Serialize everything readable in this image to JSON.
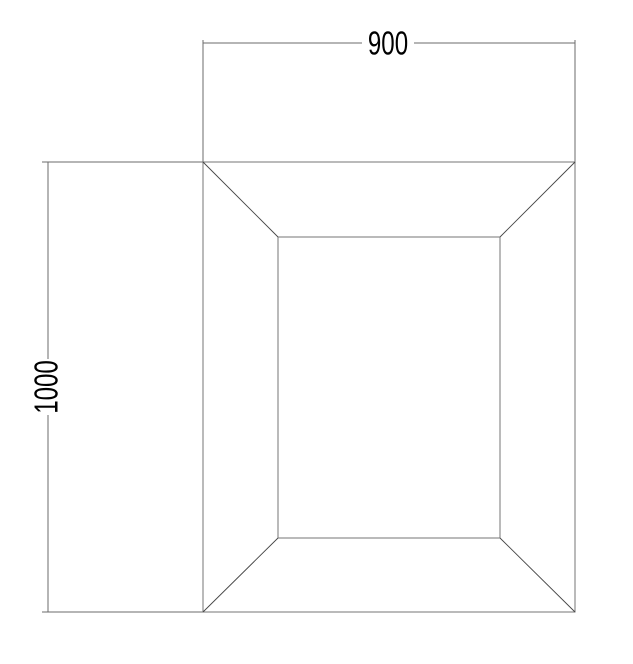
{
  "drawing": {
    "top_dimension": {
      "label": "900"
    },
    "left_dimension": {
      "label": "1000"
    },
    "colors": {
      "background": "#ffffff",
      "outline": "#757575",
      "dimension_line": "#6b6b6b",
      "diagonal": "#454545",
      "label_text": "#000000"
    },
    "geometry": {
      "outer_rect_px": {
        "x": 203,
        "y": 162,
        "width": 372,
        "height": 450
      },
      "inner_rect_px": {
        "x": 278,
        "y": 237,
        "width": 222,
        "height": 301
      }
    }
  }
}
